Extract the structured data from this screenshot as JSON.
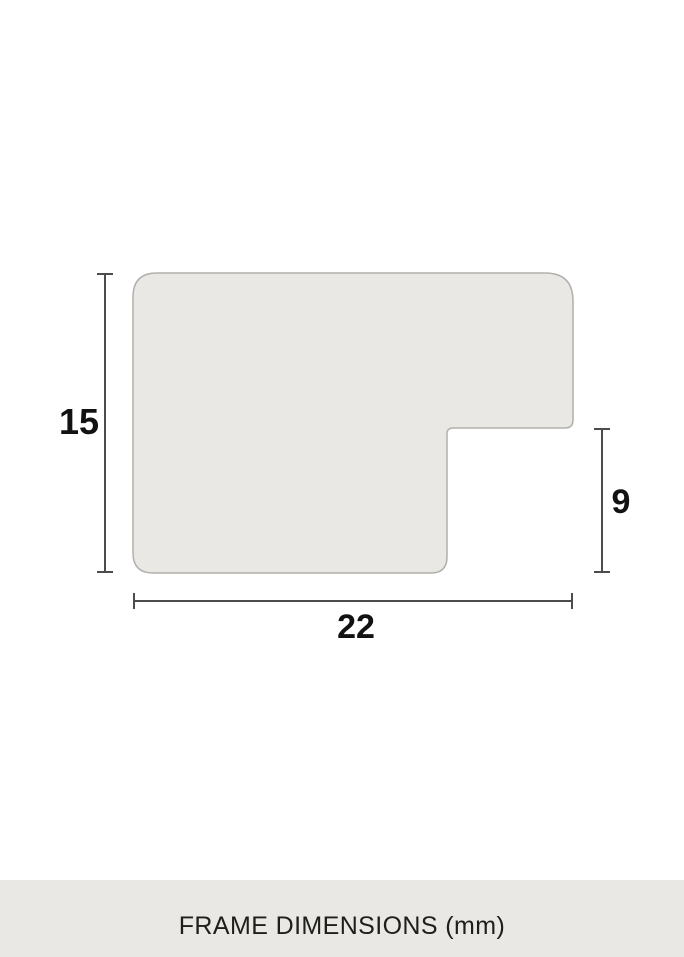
{
  "page": {
    "background": "#ffffff"
  },
  "diagram": {
    "description": "frame-profile-cross-section",
    "labels": {
      "height": "15",
      "rabbet": "9",
      "width": "22"
    },
    "colors": {
      "profile_fill": "#e9e8e4",
      "profile_stroke": "#b1b0aa",
      "dimension_line": "#4c4c4a",
      "dimension_text": "#121212"
    }
  },
  "footer": {
    "caption": "FRAME DIMENSIONS (mm)",
    "background": "#e9e8e4",
    "text_color": "#1e1e1c"
  }
}
